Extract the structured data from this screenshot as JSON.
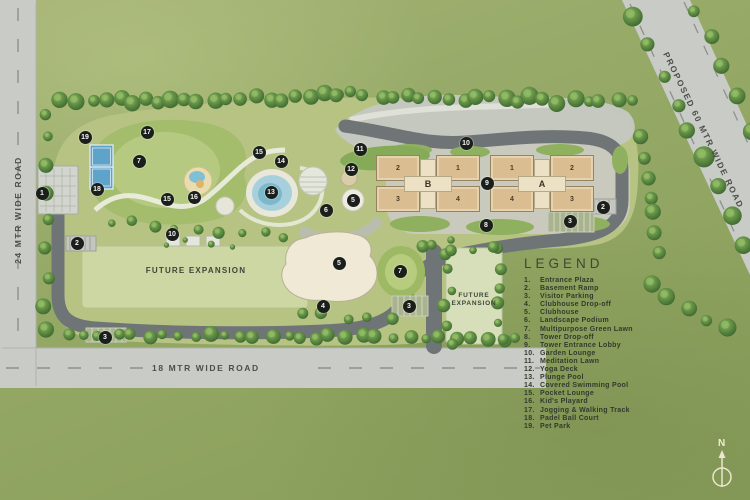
{
  "roads": {
    "left_label": "24 MTR WIDE ROAD",
    "bottom_label": "18 MTR WIDE ROAD",
    "right_label": "PROPOSED 60 MTR WIDE ROAD"
  },
  "future_expansion": {
    "large_label": "FUTURE EXPANSION",
    "small_line1": "FUTURE",
    "small_line2": "EXPANSION"
  },
  "compass": {
    "label": "N"
  },
  "legend": {
    "title": "LEGEND",
    "items": [
      {
        "num": "1.",
        "label": "Entrance Plaza"
      },
      {
        "num": "2.",
        "label": "Basement Ramp"
      },
      {
        "num": "3.",
        "label": "Visitor Parking"
      },
      {
        "num": "4.",
        "label": "Clubhouse Drop-off"
      },
      {
        "num": "5.",
        "label": "Clubhouse"
      },
      {
        "num": "6.",
        "label": "Landscape Podium"
      },
      {
        "num": "7.",
        "label": "Multipurpose Green Lawn"
      },
      {
        "num": "8.",
        "label": "Tower Drop-off"
      },
      {
        "num": "9.",
        "label": "Tower Entrance Lobby"
      },
      {
        "num": "10.",
        "label": "Garden Lounge"
      },
      {
        "num": "11.",
        "label": "Meditation Lawn"
      },
      {
        "num": "12.",
        "label": "Yoga Deck"
      },
      {
        "num": "13.",
        "label": "Plunge Pool"
      },
      {
        "num": "14.",
        "label": "Covered Swimming Pool"
      },
      {
        "num": "15.",
        "label": "Pocket Lounge"
      },
      {
        "num": "16.",
        "label": "Kid's Playard"
      },
      {
        "num": "17.",
        "label": "Jogging & Walking Track"
      },
      {
        "num": "18.",
        "label": "Padel Ball Court"
      },
      {
        "num": "19.",
        "label": "Pet Park"
      }
    ]
  },
  "towers": {
    "clusters": [
      {
        "name": "B",
        "x": 428,
        "y": 184,
        "wings": [
          {
            "label": "2",
            "x": 398,
            "y": 168
          },
          {
            "label": "1",
            "x": 458,
            "y": 168
          },
          {
            "label": "3",
            "x": 398,
            "y": 199
          },
          {
            "label": "4",
            "x": 458,
            "y": 199
          }
        ]
      },
      {
        "name": "A",
        "x": 542,
        "y": 184,
        "wings": [
          {
            "label": "1",
            "x": 512,
            "y": 168
          },
          {
            "label": "2",
            "x": 572,
            "y": 168
          },
          {
            "label": "4",
            "x": 512,
            "y": 199
          },
          {
            "label": "3",
            "x": 572,
            "y": 199
          }
        ]
      }
    ]
  },
  "markers": [
    {
      "n": "1",
      "x": 42,
      "y": 193
    },
    {
      "n": "2",
      "x": 77,
      "y": 243
    },
    {
      "n": "2",
      "x": 603,
      "y": 207
    },
    {
      "n": "3",
      "x": 105,
      "y": 337
    },
    {
      "n": "3",
      "x": 409,
      "y": 306
    },
    {
      "n": "3",
      "x": 570,
      "y": 221
    },
    {
      "n": "4",
      "x": 323,
      "y": 306
    },
    {
      "n": "5",
      "x": 353,
      "y": 200
    },
    {
      "n": "5",
      "x": 339,
      "y": 263
    },
    {
      "n": "6",
      "x": 326,
      "y": 210
    },
    {
      "n": "7",
      "x": 139,
      "y": 161
    },
    {
      "n": "7",
      "x": 400,
      "y": 271
    },
    {
      "n": "8",
      "x": 486,
      "y": 225
    },
    {
      "n": "9",
      "x": 487,
      "y": 183
    },
    {
      "n": "10",
      "x": 172,
      "y": 234
    },
    {
      "n": "10",
      "x": 466,
      "y": 143
    },
    {
      "n": "11",
      "x": 360,
      "y": 149
    },
    {
      "n": "12",
      "x": 351,
      "y": 169
    },
    {
      "n": "13",
      "x": 271,
      "y": 192
    },
    {
      "n": "14",
      "x": 281,
      "y": 161
    },
    {
      "n": "15",
      "x": 167,
      "y": 199
    },
    {
      "n": "15",
      "x": 259,
      "y": 152
    },
    {
      "n": "16",
      "x": 194,
      "y": 197
    },
    {
      "n": "17",
      "x": 147,
      "y": 132
    },
    {
      "n": "18",
      "x": 97,
      "y": 189
    },
    {
      "n": "19",
      "x": 85,
      "y": 137
    }
  ],
  "colors": {
    "field_green": "#96a967",
    "site_ground": "#b6c383",
    "podium_gray": "#c9c9bd",
    "road_dark": "#6f7476",
    "road_light": "#c9cbc7",
    "tower_tan": "#dabd91",
    "tower_core": "#ece1c4",
    "pool_blue": "#7cb8cc",
    "court_blue": "#5ea3c9",
    "marker_black": "#1b1f1b",
    "expansion_green": "#ccd7a4"
  }
}
